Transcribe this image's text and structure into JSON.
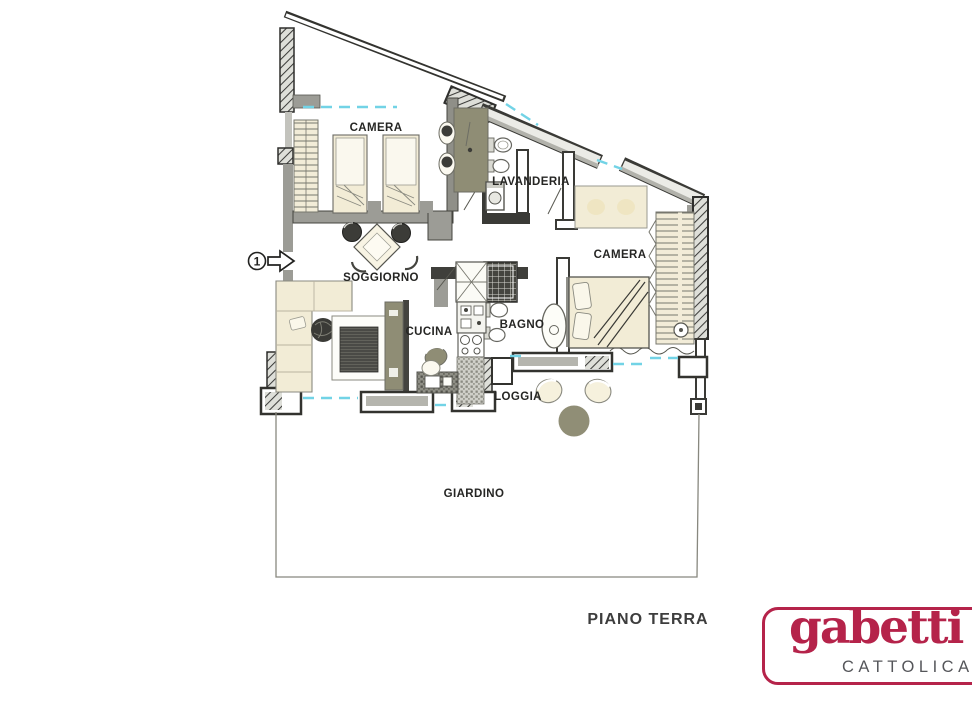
{
  "plan": {
    "floor_label": "PIANO TERRA",
    "entry_marker": "1",
    "rooms": [
      {
        "id": "camera-1",
        "label": "CAMERA"
      },
      {
        "id": "lavanderia",
        "label": "LAVANDERIA"
      },
      {
        "id": "camera-2",
        "label": "CAMERA"
      },
      {
        "id": "soggiorno",
        "label": "SOGGIORNO"
      },
      {
        "id": "cucina",
        "label": "CUCINA"
      },
      {
        "id": "bagno",
        "label": "BAGNO"
      },
      {
        "id": "loggia",
        "label": "LOGGIA"
      },
      {
        "id": "giardino",
        "label": "GIARDINO"
      }
    ],
    "colors": {
      "wall_dark": "#3a3a36",
      "wall_gray": "#9c9c96",
      "furniture_beige": "#f2ecd6",
      "accent_olive": "#8f8d75",
      "window_cyan": "#72d3e6",
      "label_text": "#262624"
    }
  },
  "logo": {
    "brand": "gabetti",
    "location": "CATTOLICA",
    "red": "#b5234a",
    "gray": "#55565a"
  }
}
